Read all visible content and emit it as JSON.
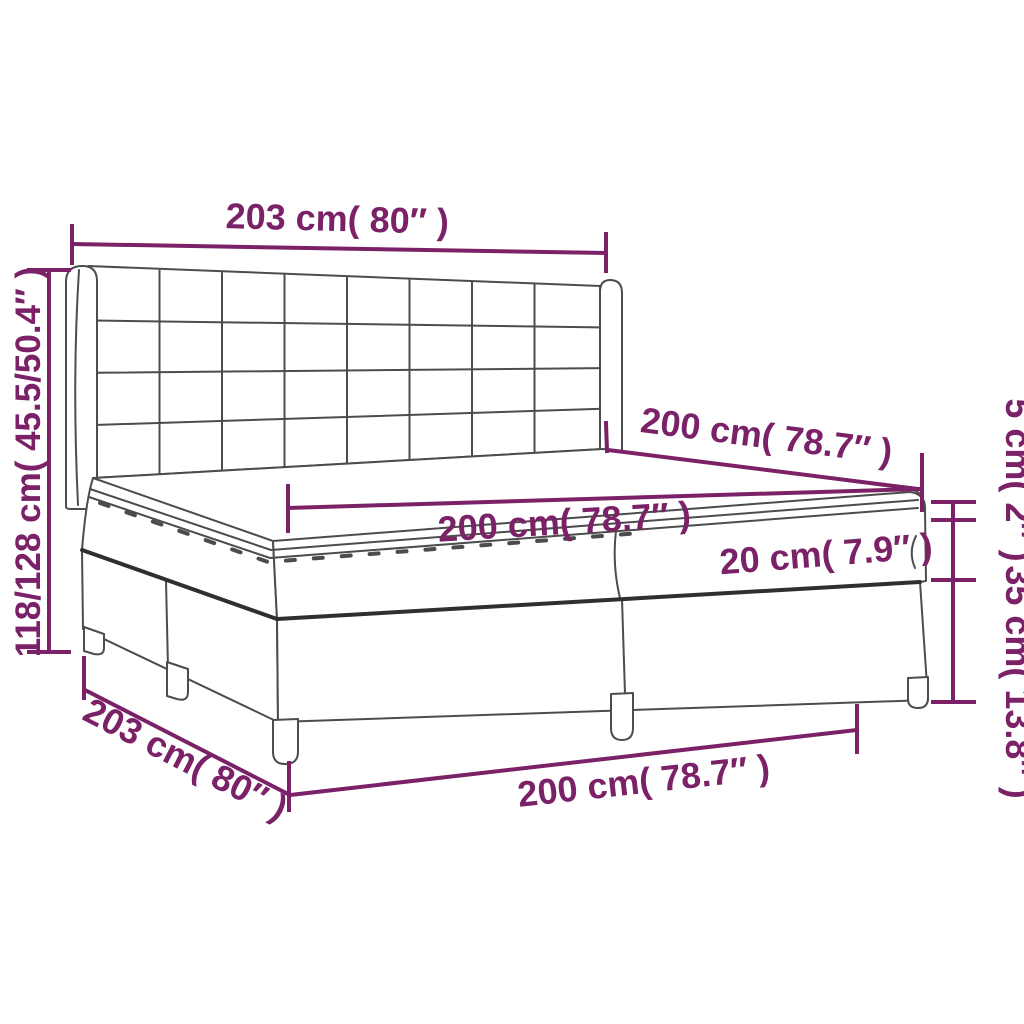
{
  "figure": {
    "type": "product dimension diagram",
    "subject": "box spring bed with tufted headboard, mattress and topper",
    "background": "#ffffff"
  },
  "colors": {
    "dimension": "#7b2167",
    "line": "#4c4c4c",
    "line_dark": "#2f2f2f",
    "fill": "#ffffff"
  },
  "labels": {
    "headboard_width_top": "203 cm( 80″ )",
    "overall_height_left": "118/128 cm( 45.5/50.4″ )",
    "mattress_length_diagonal": "200 cm( 78.7″ )",
    "mattress_width_top": "200 cm( 78.7″ )",
    "mattress_thickness": "20 cm( 7.9″ )",
    "topper_height": "5 cm( 2″ )",
    "box_height": "35 cm( 13.8″ )",
    "frame_length_bottom": "203 cm( 80″ )",
    "frame_width_bottom": "200 cm( 78.7″ )"
  }
}
